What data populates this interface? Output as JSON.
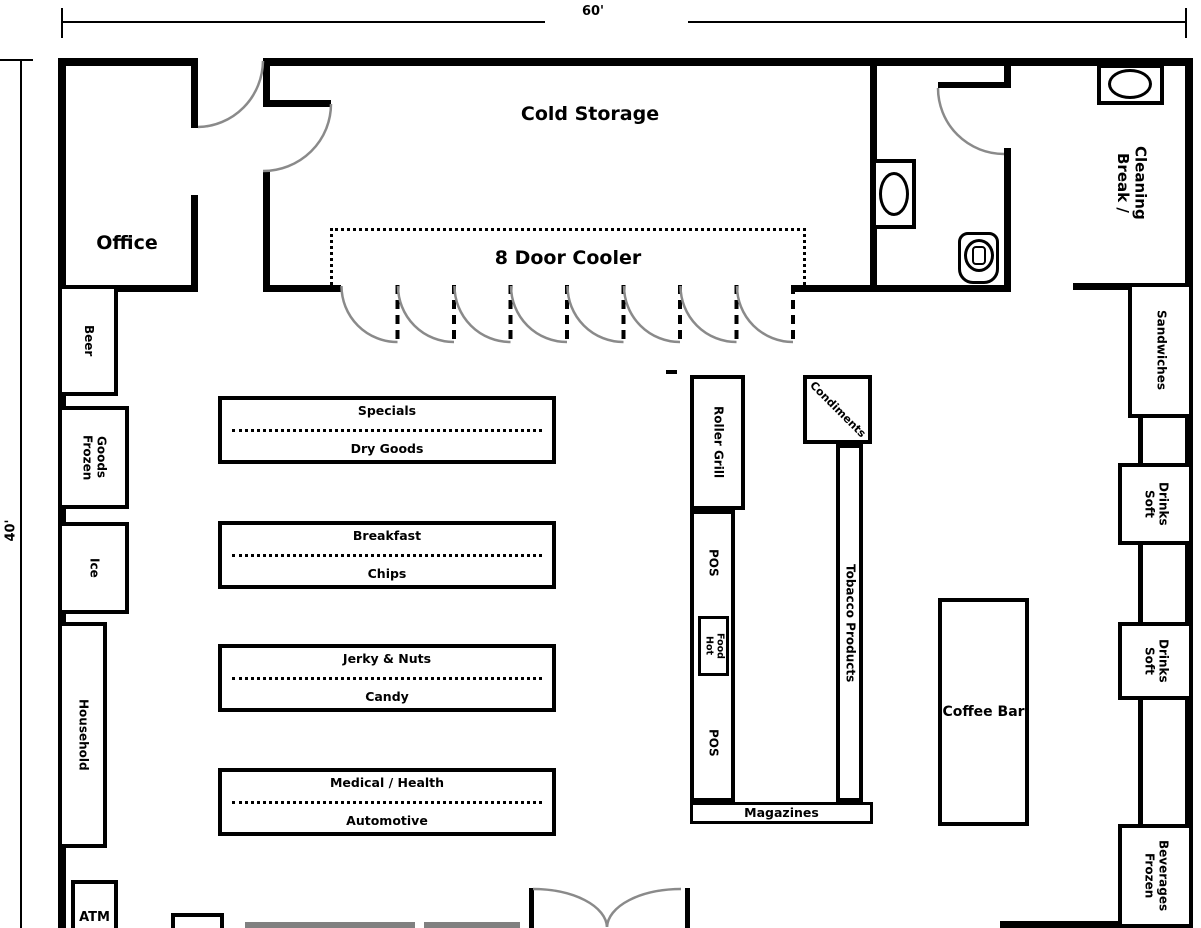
{
  "floorplan": {
    "dimensions": {
      "width_label": "60'",
      "height_label": "40'"
    },
    "rooms": {
      "office": "Office",
      "cold_storage": "Cold Storage",
      "break_cleaning": "Break /\nCleaning"
    },
    "cooler": {
      "label": "8 Door Cooler",
      "door_count": 8
    },
    "left_shelves": {
      "beer": "Beer",
      "frozen_goods": "Frozen\nGoods",
      "ice": "Ice",
      "household": "Household",
      "atm": "ATM"
    },
    "aisles": [
      {
        "top": "Specials",
        "bottom": "Dry Goods"
      },
      {
        "top": "Breakfast",
        "bottom": "Chips"
      },
      {
        "top": "Jerky & Nuts",
        "bottom": "Candy"
      },
      {
        "top": "Medical / Health",
        "bottom": "Automotive"
      }
    ],
    "checkout": {
      "roller_grill": "Roller Grill",
      "pos_top": "POS",
      "hot_food": "Hot\nFood",
      "pos_bottom": "POS",
      "condiments": "Condiments",
      "tobacco": "Tobacco Products",
      "magazines": "Magazines"
    },
    "right_shelves": {
      "sandwiches": "Sandwiches",
      "soft_drinks_1": "Soft\nDrinks",
      "soft_drinks_2": "Soft\nDrinks",
      "frozen_beverages": "Frozen\nBeverages"
    },
    "coffee_bar": "Coffee Bar",
    "colors": {
      "wall": "#000000",
      "door_arc": "#8a8a8a",
      "window": "#808080"
    }
  }
}
